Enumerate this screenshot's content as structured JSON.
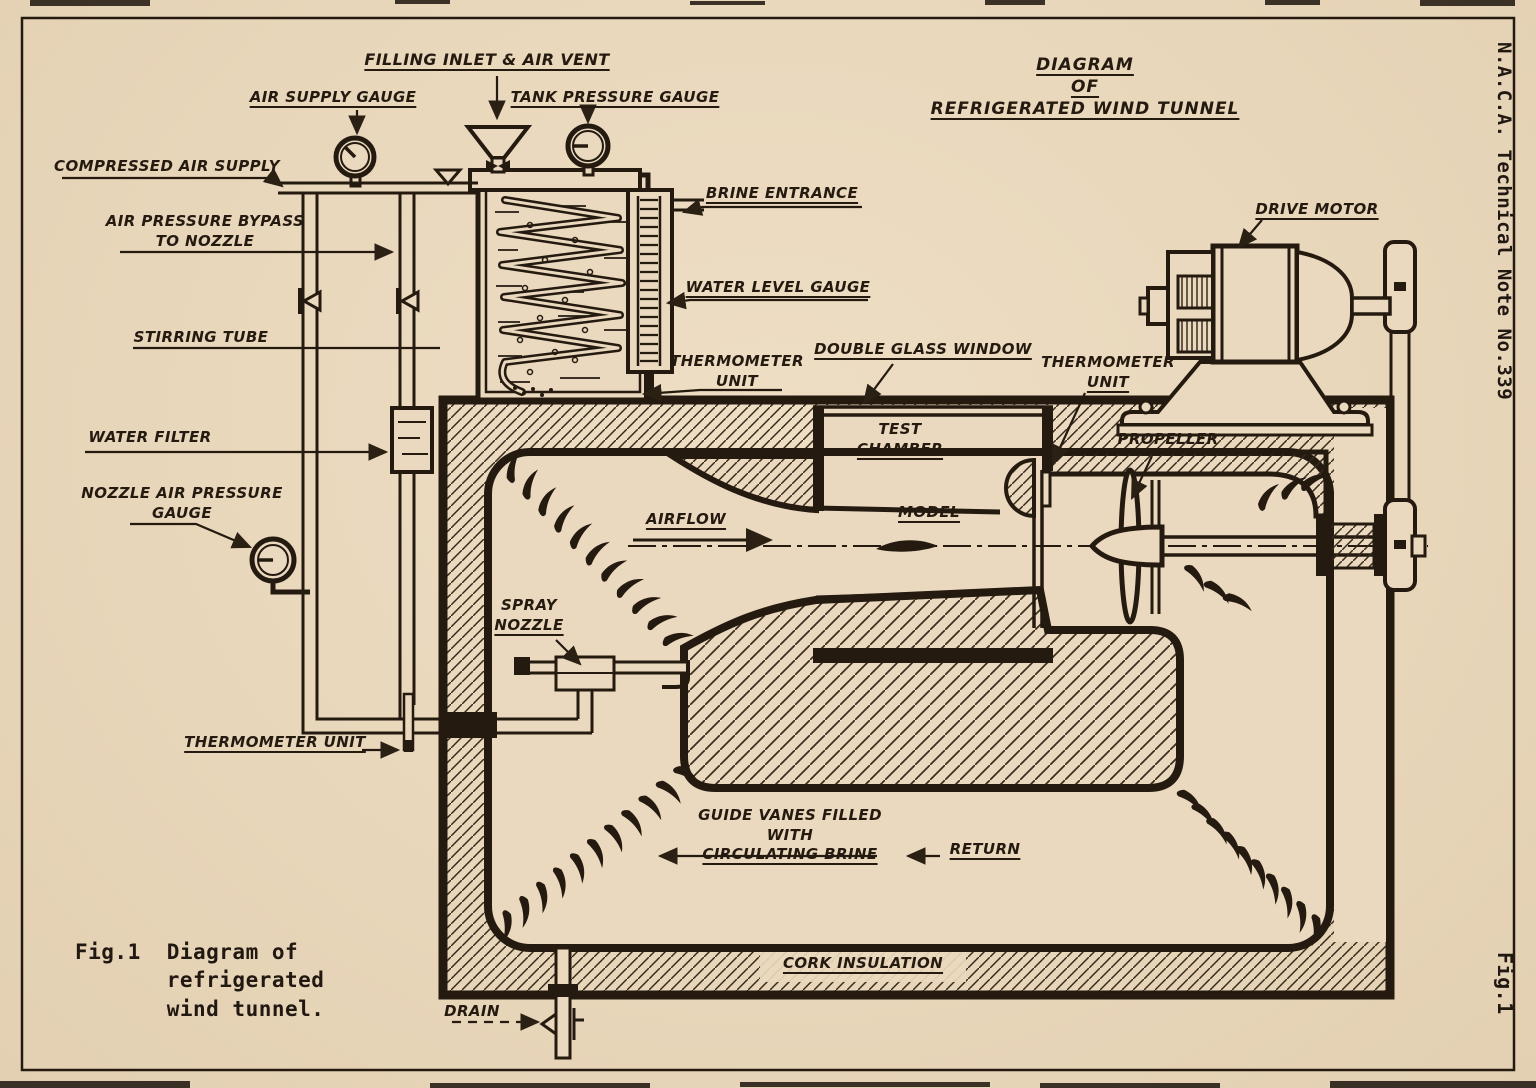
{
  "page": {
    "side_note": "N.A.C.A. Technical Note No.339",
    "side_fig": "Fig.1",
    "title": [
      "DIAGRAM",
      "OF",
      "REFRIGERATED WIND TUNNEL"
    ],
    "caption": {
      "fig": "Fig.1",
      "lines": [
        "Diagram of",
        "refrigerated",
        "wind tunnel."
      ]
    }
  },
  "labels": {
    "filling_inlet": [
      "FILLING INLET & AIR VENT"
    ],
    "air_supply_gauge": [
      "AIR SUPPLY GAUGE"
    ],
    "tank_pressure_gauge": [
      "TANK PRESSURE GAUGE"
    ],
    "compressed_air_supply": [
      "COMPRESSED AIR SUPPLY"
    ],
    "air_pressure_bypass": [
      "AIR PRESSURE BYPASS",
      "TO NOZZLE"
    ],
    "stirring_tube": [
      "STIRRING TUBE"
    ],
    "water_filter": [
      "WATER FILTER"
    ],
    "nozzle_air_pressure_gauge": [
      "NOZZLE AIR PRESSURE",
      "GAUGE"
    ],
    "brine_entrance": [
      "BRINE ENTRANCE"
    ],
    "water_level_gauge": [
      "WATER LEVEL GAUGE"
    ],
    "thermometer_unit_tank": [
      "THERMOMETER",
      "UNIT"
    ],
    "double_glass_window": [
      "DOUBLE GLASS WINDOW"
    ],
    "thermometer_unit_chamber": [
      "THERMOMETER",
      "UNIT"
    ],
    "drive_motor": [
      "DRIVE MOTOR"
    ],
    "test_chamber": [
      "TEST",
      "CHAMBER"
    ],
    "model": [
      "MODEL"
    ],
    "airflow": [
      "AIRFLOW"
    ],
    "propeller": [
      "PROPELLER"
    ],
    "spray_nozzle": [
      "SPRAY",
      "NOZZLE"
    ],
    "thermometer_unit_pipe": [
      "THERMOMETER UNIT"
    ],
    "guide_vanes": [
      "GUIDE VANES FILLED",
      "WITH",
      "CIRCULATING BRINE"
    ],
    "return_flow": [
      "RETURN"
    ],
    "cork_insulation": [
      "CORK INSULATION"
    ],
    "drain": [
      "DRAIN"
    ]
  },
  "colors": {
    "paper": "#ead9be",
    "ink": "#2b2014"
  }
}
